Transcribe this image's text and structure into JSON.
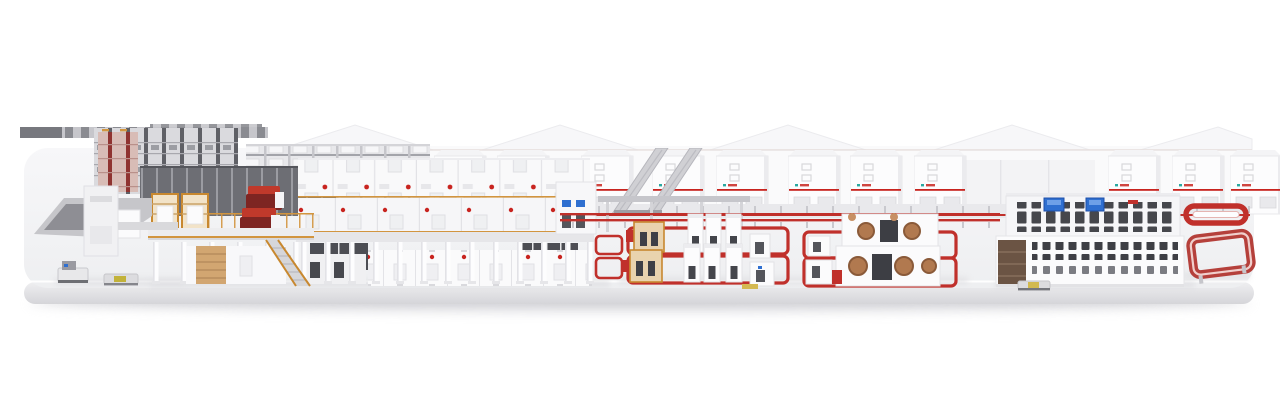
{
  "scene": {
    "type": "3d-render",
    "subject": "corrugated-board-production-line-panorama",
    "sections": [
      "platform-shadow",
      "platform-slab",
      "distant-machinery-strip",
      "roll-storage-racks",
      "shelf-storage-block",
      "factory-wall-gables",
      "hood-cabinet-row",
      "incline-conveyor-bridges",
      "splice-platform",
      "agv-shuttles",
      "wet-end-mezzanine",
      "single-facer-units",
      "corrugator-dry-end",
      "support-columns",
      "control-cabinets",
      "overhead-duct",
      "floor-conveyor-lines",
      "conversion-cell-left",
      "conversion-cell-right",
      "reel-stand-machines",
      "logistics-building",
      "operator-screens",
      "elevated-conveyor-pill",
      "elevated-conveyor-racetrack"
    ],
    "visible_text": []
  },
  "palette": {
    "background": "#ffffff",
    "platform_top": "#f2f2f4",
    "platform_front_light": "#efeff1",
    "platform_front_dark": "#d5d5d9",
    "shadow": "#c9c9cf",
    "machine_white": "#fafafb",
    "machine_shade": "#e3e3e7",
    "dark_panel": "#4d4e54",
    "dark_wall": "#6d6e74",
    "rack_gray": "#5f6066",
    "accent_red": "#c8241f",
    "conveyor_red": "#c0302b",
    "maroon_hood": "#7e2522",
    "bright_red": "#c0392b",
    "rail_orange": "#d2953f",
    "pallet_tan": "#d2a671",
    "roll_copper": "#b1794f",
    "screen_blue": "#2f6fd0",
    "logo_teal": "#2aa8a0"
  }
}
